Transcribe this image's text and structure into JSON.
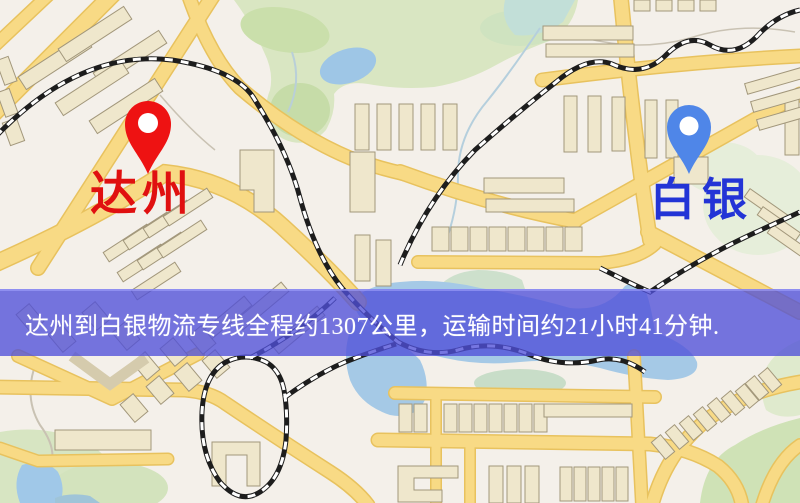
{
  "markers": {
    "origin": {
      "label": "达州",
      "pin_icon": "red-pin-icon",
      "pin_color": "#ee1212",
      "label_color": "#e01010"
    },
    "destination": {
      "label": "白银",
      "pin_icon": "blue-pin-icon",
      "pin_color": "#4f86e8",
      "label_color": "#2334d6"
    }
  },
  "banner": {
    "text": "达州到白银物流专线全程约1307公里，运输时间约21小时41分钟.",
    "background_color": "#4f4fd8",
    "text_color": "#ffffff"
  },
  "route": {
    "origin": "达州",
    "destination": "白银",
    "distance_km": 1307,
    "duration_hours": 21,
    "duration_minutes": 41
  },
  "map_colors": {
    "background": "#f4f0ea",
    "road_fill": "#f8da85",
    "road_casing": "#e8c25e",
    "building_fill": "#efe7cc",
    "building_outline": "#a2977b",
    "park": "#d9e6c2",
    "water": "#a5c9e6",
    "railway": "#1d1d1d"
  }
}
